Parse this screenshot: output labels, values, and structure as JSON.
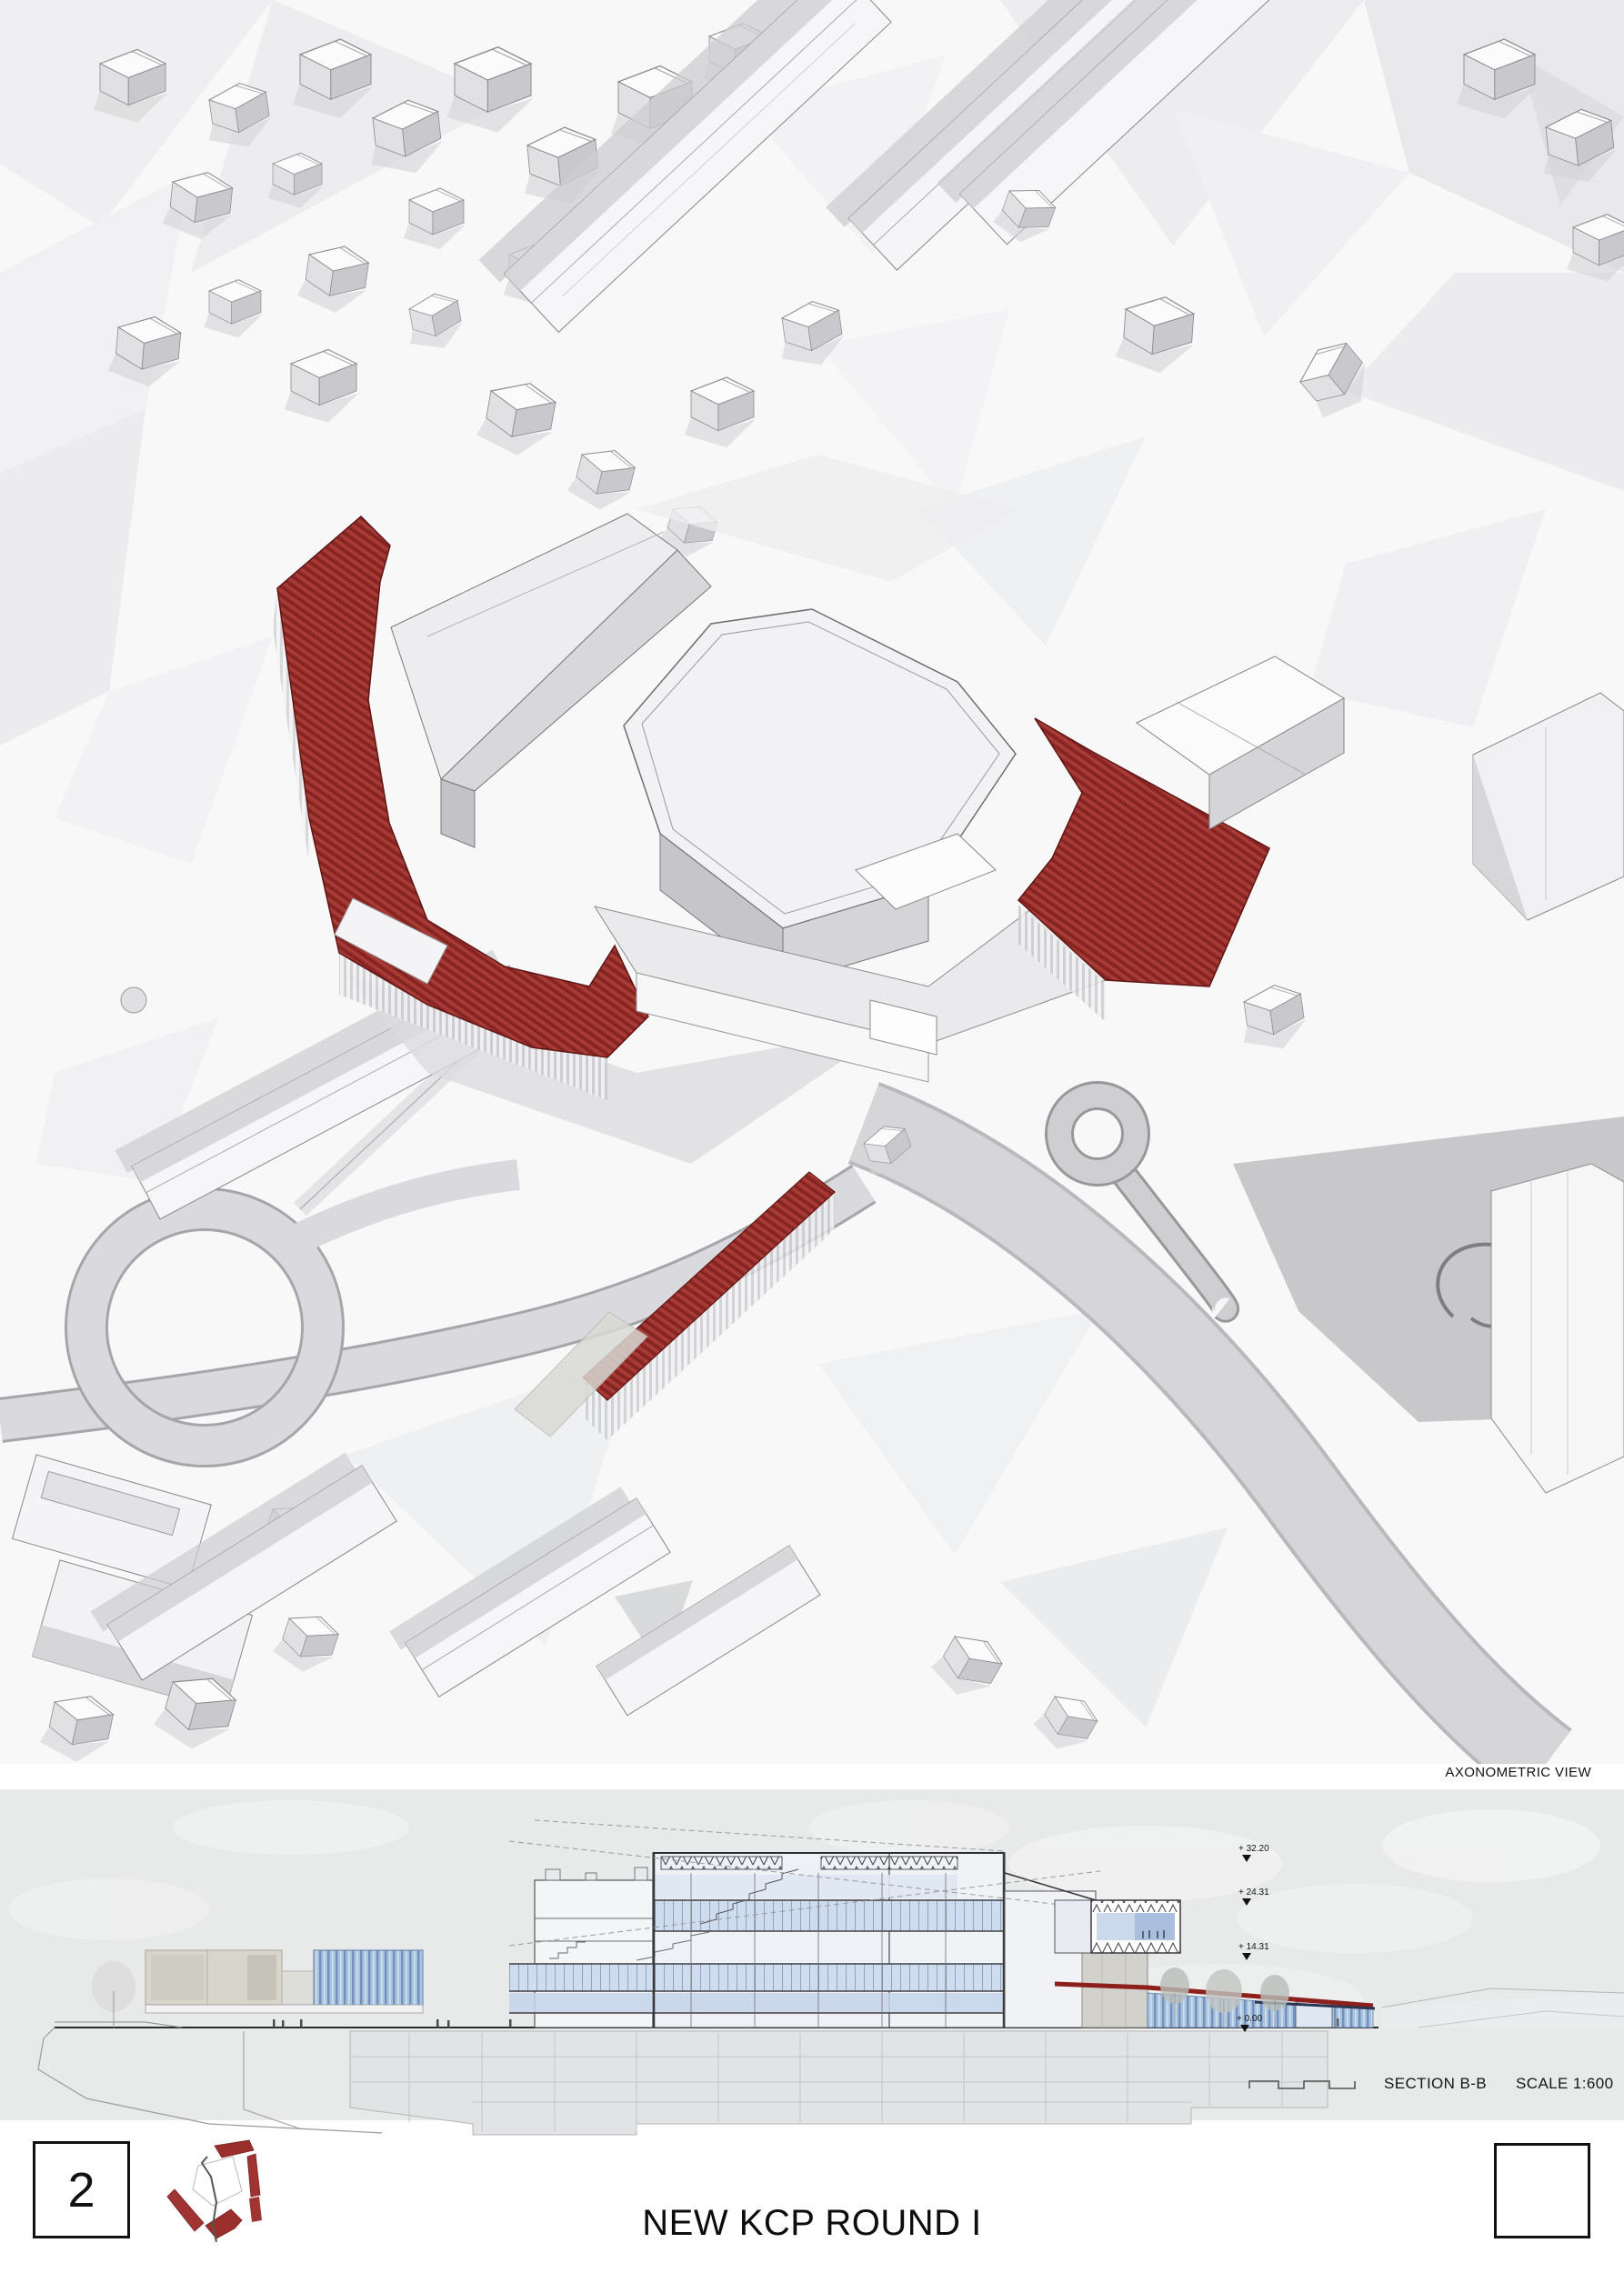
{
  "board": {
    "axon_label": "AXONOMETRIC VIEW",
    "section_label": "SECTION B-B",
    "scale_label": "SCALE 1:600",
    "sheet_number": "2",
    "title": "NEW KCP ROUND I",
    "levels": [
      "+ 32.20",
      "+ 24.31",
      "+ 14.31",
      "+ 0.00"
    ]
  },
  "colors": {
    "accent_red": "#9b2f2c",
    "deep_red": "#7c211f",
    "roofline_red": "#8d1f1c",
    "glass_blue": "#a9c2de",
    "glass_blue_light": "#cfdcee",
    "sky_gray": "#e8e9e9",
    "building_top": "#fafafb",
    "building_side": "#c9c9cd",
    "road_gray": "#dadade",
    "ink": "#111111"
  }
}
